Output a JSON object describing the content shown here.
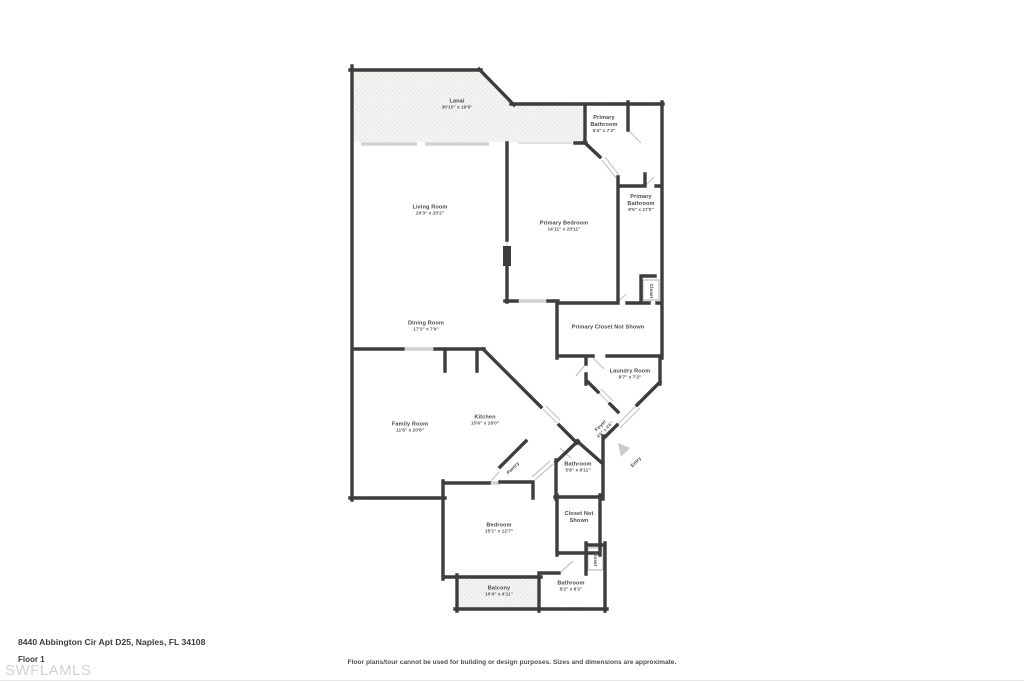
{
  "colors": {
    "wall": "#3d3d3d",
    "window": "#d2d2d2",
    "door_swing": "#c5c5c5",
    "hatch_background": "#f4f3f1",
    "hatch_dot": "#dedede",
    "label_text": "#4a4a4a",
    "watermark_text": "#d2d2d2"
  },
  "rooms": [
    {
      "name": "Lanai",
      "dims": "30'10\" x 19'6\""
    },
    {
      "name": "Primary Bathroom",
      "dims": "5'4\" x 7'2\""
    },
    {
      "name": "Primary Bathroom",
      "dims": "9'5\" x 27'0\""
    },
    {
      "name": "Primary Bedroom",
      "dims": "14'11\" x 20'11\""
    },
    {
      "name": "Living Room",
      "dims": "20'3\" x 20'2\""
    },
    {
      "name": "Dining Room",
      "dims": "17'2\" x 7'9\""
    },
    {
      "name": "Primary Closet Not Shown",
      "dims": ""
    },
    {
      "name": "Closet",
      "dims": ""
    },
    {
      "name": "Laundry Room",
      "dims": "9'7\" x 7'2\""
    },
    {
      "name": "Kitchen",
      "dims": "15'6\" x 18'0\""
    },
    {
      "name": "Family Room",
      "dims": "11'6\" x 20'8\""
    },
    {
      "name": "Pantry",
      "dims": ""
    },
    {
      "name": "Foyer",
      "dims": "4'6\" x 4'6\""
    },
    {
      "name": "Entry",
      "dims": ""
    },
    {
      "name": "Bathroom",
      "dims": "5'8\" x 6'11\""
    },
    {
      "name": "Bedroom",
      "dims": "15'1\" x 12'7\""
    },
    {
      "name": "Closet Not Shown",
      "dims": ""
    },
    {
      "name": "Closet",
      "dims": ""
    },
    {
      "name": "Bathroom",
      "dims": "8'2\" x 8'2\""
    },
    {
      "name": "Balcony",
      "dims": "10'4\" x 4'11\""
    }
  ],
  "footer": {
    "address": "8440 Abbington Cir Apt D25, Naples, FL 34108",
    "floor_label": "Floor 1",
    "watermark": "SWFLAMLS",
    "disclaimer": "Floor plans/tour cannot be used for building or design purposes. Sizes and dimensions are approximate."
  }
}
